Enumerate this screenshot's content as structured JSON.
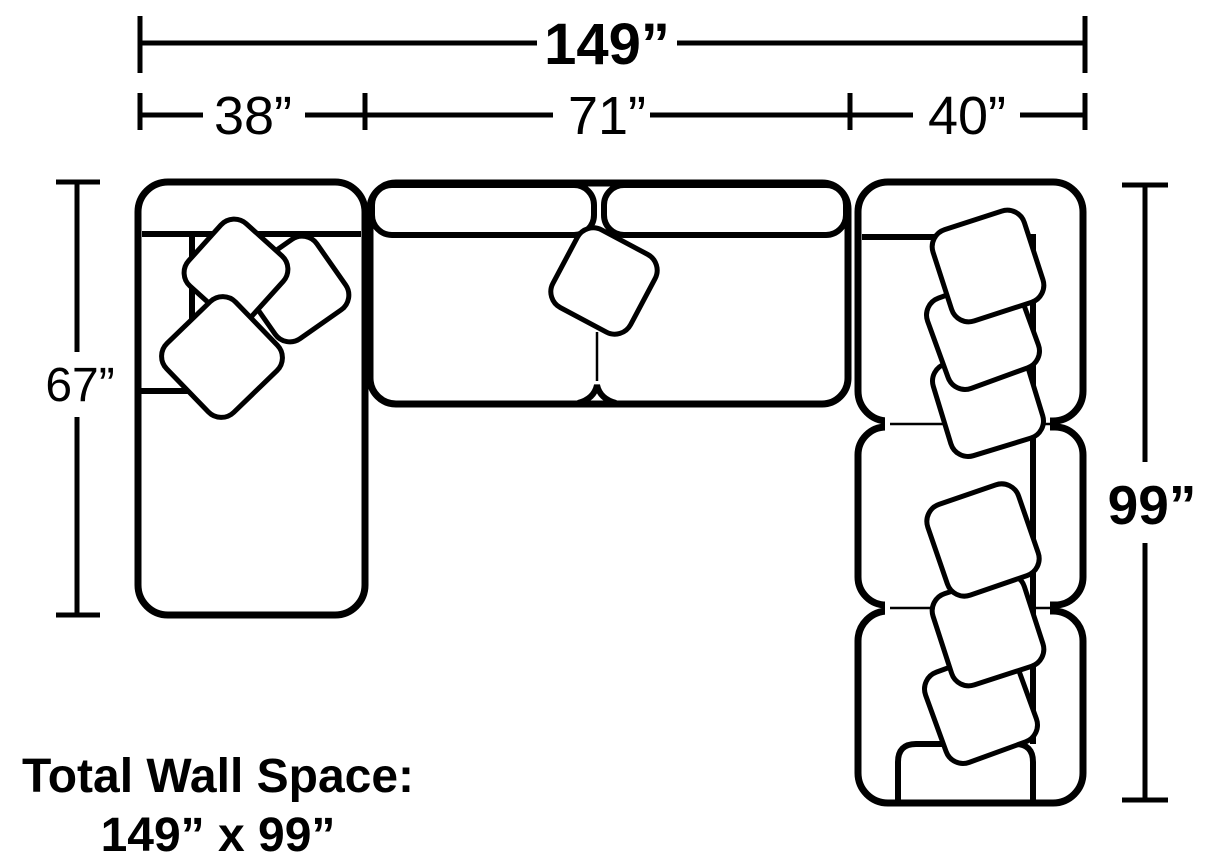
{
  "colors": {
    "line": "#000000",
    "background": "#ffffff"
  },
  "dimensions": {
    "total_width_label": "149”",
    "segment_labels": [
      "38”",
      "71”",
      "40”"
    ],
    "left_depth_label": "67”",
    "right_depth_label": "99”"
  },
  "caption": {
    "line1": "Total Wall Space:",
    "line2": "149” x 99”"
  }
}
